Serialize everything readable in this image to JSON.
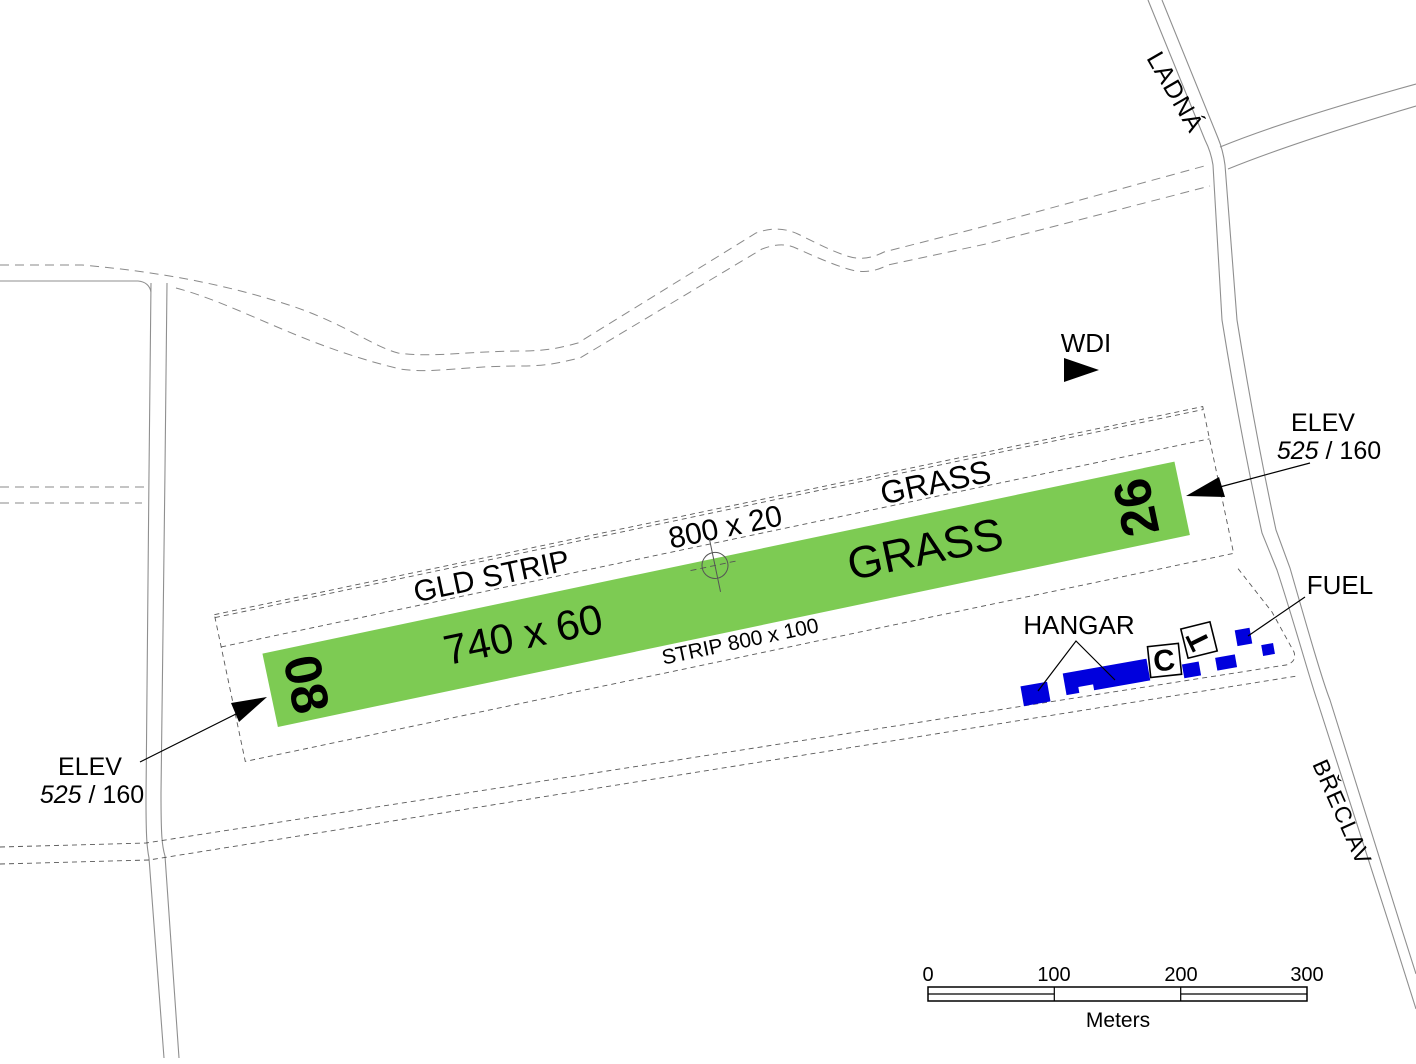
{
  "colors": {
    "strip_light": "#e4f1cf",
    "runway_green": "#7dcb53",
    "building_blue": "#0000dd"
  },
  "strip": {
    "gld_label": "GLD STRIP",
    "gld_dimensions": "800 x 20",
    "gld_surface": "GRASS",
    "strip_dimensions_label": "STRIP 800 x 100"
  },
  "runway": {
    "dimensions": "740 x 60",
    "surface": "GRASS",
    "designator_west": "08",
    "designator_east": "26"
  },
  "elevation_west": {
    "label": "ELEV",
    "value_italic": "525",
    "value_rest": " / 160"
  },
  "elevation_east": {
    "label": "ELEV",
    "value_italic": "525",
    "value_rest": " / 160"
  },
  "features": {
    "wdi_label": "WDI",
    "hangar_label": "HANGAR",
    "fuel_label": "FUEL",
    "box_c": "C",
    "box_t": "T"
  },
  "roads": {
    "north_label": "LADNÁ",
    "southeast_label": "BŘECLAV"
  },
  "scalebar": {
    "tick_0": "0",
    "tick_100": "100",
    "tick_200": "200",
    "tick_300": "300",
    "unit_label": "Meters"
  }
}
